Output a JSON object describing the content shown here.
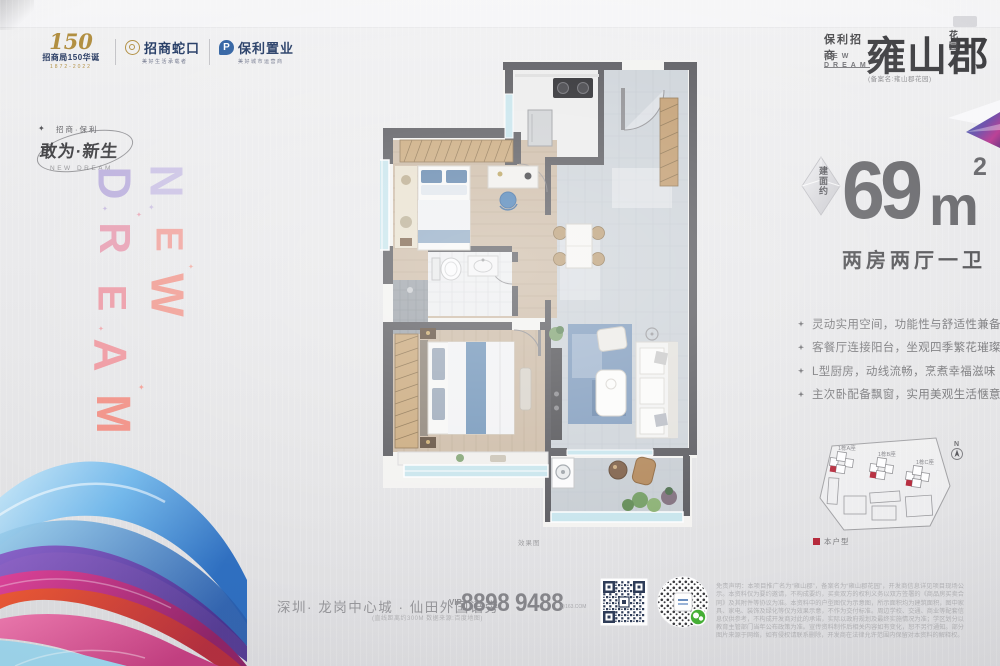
{
  "header": {
    "logo150": {
      "num": "150",
      "line": "招商局150华诞",
      "years": "1872-2022"
    },
    "cmsk": {
      "name": "招商蛇口",
      "tagline": "美好生活承载者"
    },
    "poly": {
      "name": "保利置业",
      "tagline": "美好城市运营商"
    }
  },
  "brand": {
    "names": "保利招商",
    "en_line1": "NEW",
    "en_line2": "DREAM",
    "project": "雍山郡",
    "suffix": "花园",
    "filing": "(备案名:雍山郡花园)"
  },
  "slogan": {
    "small": "招商·保利",
    "main": "敢为·新生",
    "en": "NEW DREAM"
  },
  "letters": {
    "col_new": [
      "N",
      "E",
      "W"
    ],
    "col_dream": [
      "D",
      "R",
      "E",
      "A",
      "M"
    ]
  },
  "icons": {
    "sparkle": "✦"
  },
  "area": {
    "badge": "建面约",
    "value": "69",
    "unit": "m",
    "sup": "2",
    "layout": "两房两厅一卫"
  },
  "features": [
    "灵动实用空间，功能性与舒适性兼备",
    "客餐厅连接阳台，坐观四季繁花璀璨",
    "L型厨房，动线流畅，烹煮幸福滋味",
    "主次卧配备飘窗，实用美观生活惬意"
  ],
  "siteplan": {
    "buildings": [
      "1栋A座",
      "1栋B座",
      "1栋C座"
    ],
    "compass": "N",
    "legend": "本户型"
  },
  "floorplan": {
    "caption": "效果图"
  },
  "contact": {
    "address": "深圳· 龙岗中心城 · 仙田外国语旁",
    "note": "(直线距离约300M 数据来源:百度地图)",
    "vip": "VIP",
    "phone": "8898 9488",
    "ext": "@163.COM"
  },
  "disclaimer": "免责声明：本项目推广名为“雍山郡”，备案名为“雍山郡花园”，开发商信息详见项目现场公示。本资料仅为要约邀请，不构成要约，买卖双方的权利义务以双方签署的《商品房买卖合同》及其附件等协议为准。本资料中的户型图仅为示意图，所示面积均为建筑面积，图中家具、家电、装饰及绿化等仅为效果示意，不作为交付标准。周边学校、交通、商业等配套信息仅供参考，不构成开发商对此的承诺，实际以政府规划及最终实施情况为准；学区划分以教育主管部门当年公布政策为准。宣传资料制作后相关内容如有变化，恕不另行通知。部分图片来源于网络，如有侵权请联系删除，开发商在法律允许范围内保留对本资料的解释权。",
  "colors": {
    "accent_red": "#b5283a",
    "brand_navy": "#1d3560",
    "gold": "#b08d3e"
  }
}
